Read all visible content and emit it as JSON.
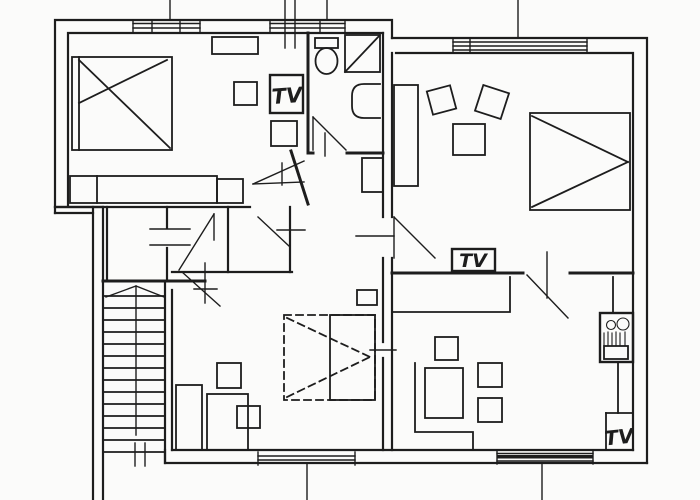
{
  "canvas": {
    "width": 700,
    "height": 500
  },
  "colors": {
    "ink": "#1d1d1d",
    "paper": "#fbfbfa"
  },
  "labels": {
    "tv_top_left_room": "TV",
    "tv_right_room": "TV",
    "tv_kitchen": "TV"
  }
}
